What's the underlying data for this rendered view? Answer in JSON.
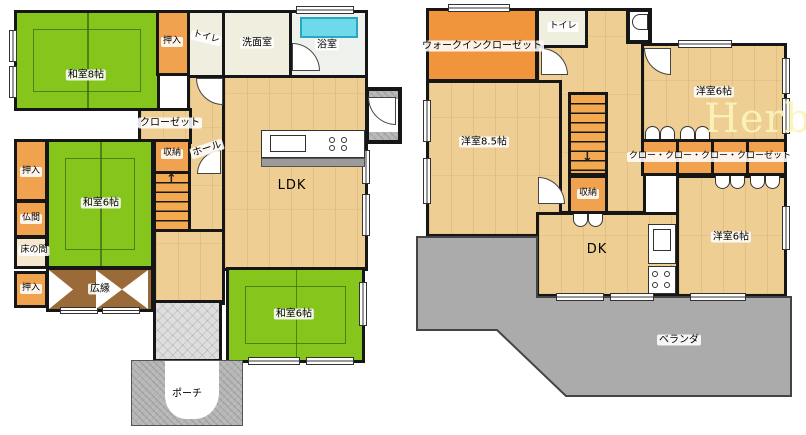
{
  "watermark": "Herb",
  "floor1": {
    "rooms": {
      "washitsu8": "和室8帖",
      "oshiire_top": "押入",
      "toilet": "トイレ",
      "senmenshitsu": "洗面室",
      "yokushitsu": "浴室",
      "closet": "クローゼット",
      "shunou": "収納",
      "hall": "ホール",
      "ldk": "LDK",
      "washitsu6_left": "和室6帖",
      "oshiire_left": "押入",
      "butsuma": "仏間",
      "tokonoma": "床の間",
      "oshiire_bottom": "押入",
      "hiroen": "広縁",
      "washitsu6_bottom": "和室6帖",
      "porch": "ポーチ"
    }
  },
  "floor2": {
    "rooms": {
      "walk_in_closet": "ウォークインクローゼット",
      "toilet": "トイレ",
      "yoshitsu85": "洋室8.5帖",
      "yoshitsu6_top": "洋室6帖",
      "closet_row": "クロー・クロー・クロー・クローゼット",
      "shunou": "収納",
      "dk": "DK",
      "yoshitsu6_bottom": "洋室6帖",
      "veranda": "ベランダ"
    }
  },
  "icons": {
    "stairs_up": "↑",
    "stairs_down": "↓"
  },
  "colors": {
    "tatami_green": "#86C61C",
    "wood_tan": "#EFCE93",
    "closet_orange": "#F0A24E",
    "wic_orange": "#F0953C",
    "bath_tub_cyan": "#6ED9E9",
    "hiroen_brown": "#9A6B38",
    "porch_gray": "#B6B6B6",
    "veranda_gray": "#ABABAB",
    "wall_black": "#161616"
  }
}
